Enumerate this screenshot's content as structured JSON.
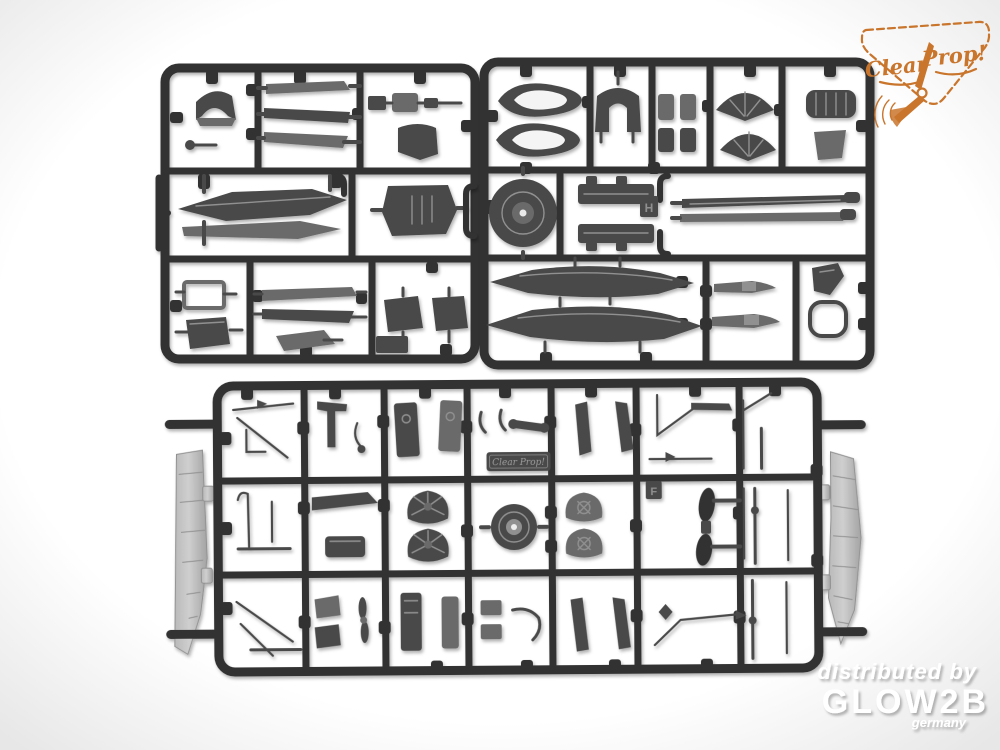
{
  "scene": {
    "description": "Top-down product photo of three dark grey injection-moulded plastic model-kit sprues (runner frames) full of aircraft parts on a white studio background",
    "kind": "model-kit-sprue-photo"
  },
  "brand_badge": {
    "word1": "Clear",
    "word2": "Prop!",
    "icon": "propeller",
    "color": "#c9752c"
  },
  "sprues": [
    {
      "id": "sprue-top-left",
      "position": "upper left"
    },
    {
      "id": "sprue-top-right",
      "position": "upper right"
    },
    {
      "id": "sprue-bottom",
      "position": "lower center, with two clear wing panels attached outside the frame"
    }
  ],
  "embossed_plate": {
    "text": "Clear Prop!"
  },
  "part_markers": {
    "h": "H",
    "f": "F"
  },
  "watermark": {
    "line1": "distributed by",
    "brand": "GLOW2B",
    "country": "germany"
  },
  "colors": {
    "bg_center": "#ffffff",
    "bg_edge": "#e7e7e7",
    "sprue_dark": "#333333",
    "part_gray": "#6b6b6b",
    "part_dark": "#4a4a4a",
    "part_light": "#909090",
    "clear_part": "#b9b9b9",
    "logo_orange": "#c9752c",
    "watermark_white": "#ffffff"
  }
}
